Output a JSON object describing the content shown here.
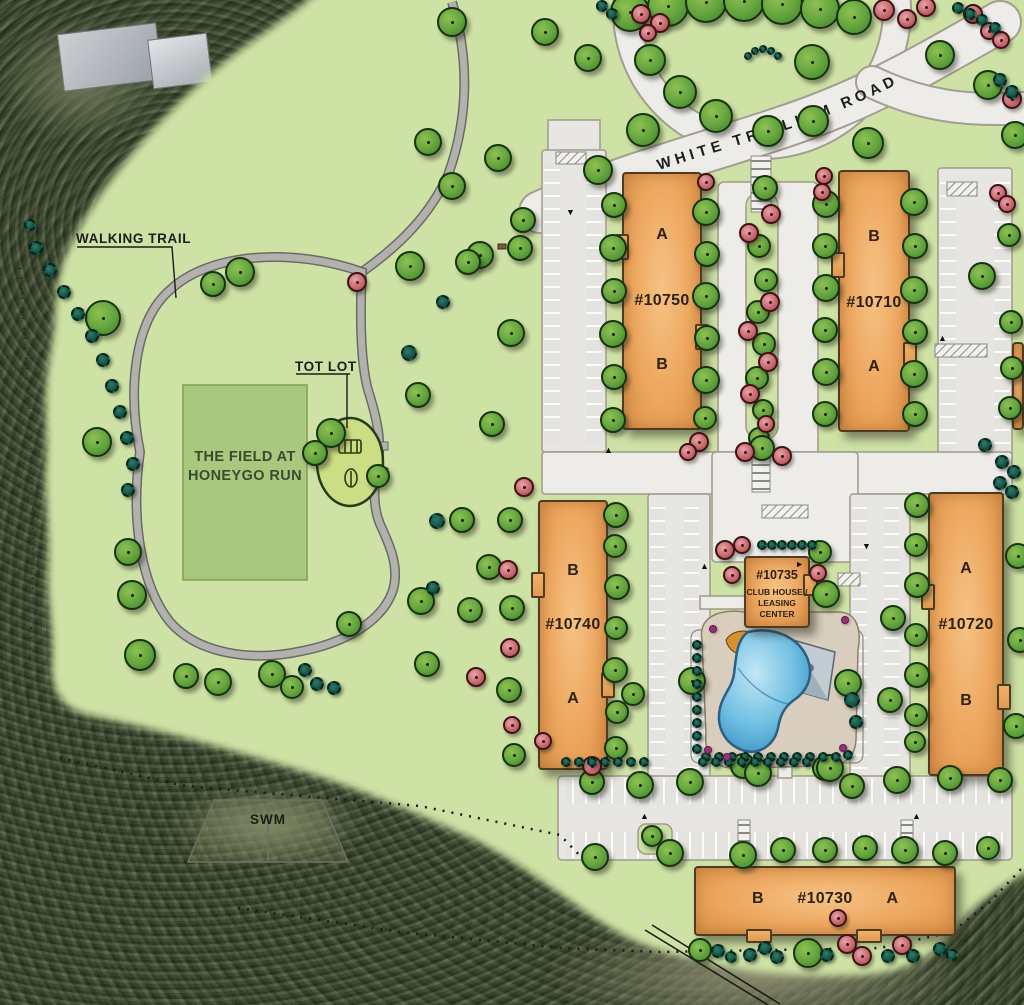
{
  "map": {
    "road_label": "WHITE TRILLIUM ROAD",
    "walking_trail_label": "WALKING TRAIL",
    "tot_lot_label": "TOT LOT",
    "field_label_line1": "THE FIELD AT",
    "field_label_line2": "HONEYGO RUN",
    "swm_label": "SWM"
  },
  "buildings": [
    {
      "number": "#10750",
      "end_top": "A",
      "end_bottom": "B"
    },
    {
      "number": "#10710",
      "end_top": "B",
      "end_bottom": "A"
    },
    {
      "number": "#10740",
      "end_top": "B",
      "end_bottom": "A"
    },
    {
      "number": "#10720",
      "end_top": "A",
      "end_bottom": "B"
    },
    {
      "number": "#10730",
      "end_left": "B",
      "end_right": "A"
    }
  ],
  "clubhouse": {
    "number": "#10735",
    "name_line1": "CLUB HOUSE /",
    "name_line2": "LEASING",
    "name_line3": "CENTER"
  },
  "colors": {
    "plan_green": "#cfe2a5",
    "field_green": "#a9c77d",
    "totlot_green": "#ccdd84",
    "road_fill": "#edece8",
    "lot_fill": "#e7e6e2",
    "road_edge": "#a29c90",
    "building_fill": "#eda75f",
    "building_edge": "#4f3b22",
    "label_ink": "#1d1d1d",
    "pool_blue": "#58b2da",
    "aerial_base": "#5a644c",
    "trail_gray": "#b3b1ad"
  }
}
